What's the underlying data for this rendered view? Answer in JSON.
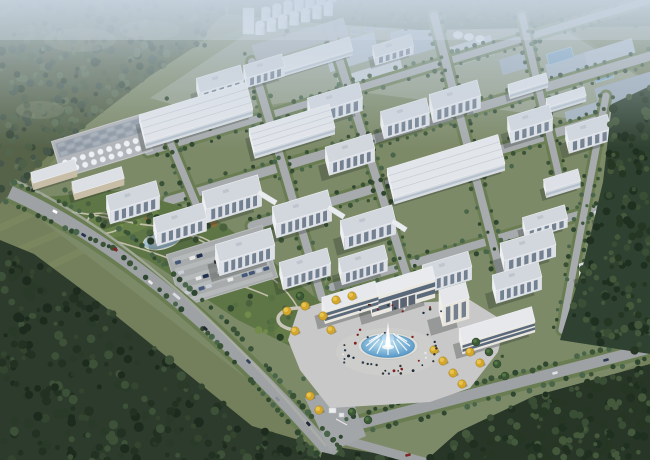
{
  "scene": {
    "kind": "aerial-architectural-rendering",
    "subject": "industrial-park-campus-birdseye",
    "canvas": {
      "width": 650,
      "height": 460
    }
  },
  "palette": {
    "field": "#74805c",
    "campus_lawn": "#7d8a68",
    "road": "#9ea2a4",
    "road_minor": "#a7abad",
    "road_verge": "#6a7d52",
    "forest_base_nw": "#566349",
    "forest_base_sw": "#2c3b2b",
    "forest_base_e": "#2f4130",
    "top_strip_base": "#4e5f45",
    "haze": "#c7d5e3",
    "roof_light": "#e0e3e8",
    "roof_ms": "#d2d7de",
    "facade_front": "#dde1e7",
    "facade_left": "#edeff2",
    "window_glass": "#5f6e80",
    "gate_glass": "#4b5c70",
    "gate_wall": "#e9e7e0",
    "plaza": "#c8c8c8",
    "water_light": "#bfe2f2",
    "water_deep": "#4f93c4",
    "pond_light": "#cfe4ee",
    "pond_deep": "#7fa4bb",
    "autumn_tree": "#d3a72c",
    "tank_white": "#edf1f5",
    "silo_white": "#f0f4f8",
    "shadow": "rgba(38,48,40,0.30)"
  },
  "axes": {
    "L": [
      0.956,
      -0.292
    ],
    "W": [
      0.24,
      0.97
    ]
  },
  "regions": {
    "campus": [
      [
        18,
        202
      ],
      [
        132,
        68
      ],
      [
        250,
        26
      ],
      [
        300,
        12
      ],
      [
        545,
        12
      ],
      [
        650,
        82
      ],
      [
        650,
        358
      ],
      [
        432,
        462
      ],
      [
        326,
        440
      ]
    ],
    "forest_nw": [
      [
        0,
        0
      ],
      [
        232,
        0
      ],
      [
        196,
        46
      ],
      [
        150,
        76
      ],
      [
        98,
        116
      ],
      [
        50,
        154
      ],
      [
        0,
        204
      ]
    ],
    "forest_sw": [
      [
        0,
        240
      ],
      [
        34,
        254
      ],
      [
        104,
        306
      ],
      [
        178,
        366
      ],
      [
        252,
        426
      ],
      [
        306,
        442
      ],
      [
        430,
        462
      ],
      [
        0,
        462
      ]
    ],
    "forest_e1": [
      [
        612,
        104
      ],
      [
        650,
        86
      ],
      [
        650,
        354
      ],
      [
        560,
        340
      ],
      [
        584,
        262
      ],
      [
        603,
        182
      ]
    ],
    "forest_e2": [
      [
        322,
        452
      ],
      [
        356,
        460
      ],
      [
        424,
        462
      ],
      [
        458,
        432
      ],
      [
        534,
        396
      ],
      [
        650,
        364
      ],
      [
        650,
        460
      ],
      [
        320,
        460
      ]
    ],
    "top_strip": [
      [
        228,
        0
      ],
      [
        650,
        0
      ],
      [
        650,
        26
      ],
      [
        420,
        30
      ],
      [
        300,
        22
      ],
      [
        228,
        14
      ]
    ],
    "park": [
      [
        34,
        198
      ],
      [
        124,
        190
      ],
      [
        208,
        214
      ],
      [
        262,
        252
      ],
      [
        318,
        300
      ],
      [
        340,
        338
      ],
      [
        306,
        354
      ],
      [
        238,
        320
      ],
      [
        148,
        260
      ],
      [
        56,
        222
      ]
    ],
    "haze_zone": [
      [
        150,
        98
      ],
      [
        252,
        30
      ],
      [
        540,
        14
      ],
      [
        650,
        84
      ],
      [
        650,
        140
      ],
      [
        580,
        120
      ],
      [
        360,
        92
      ],
      [
        205,
        114
      ]
    ],
    "plaza": [
      [
        298,
        310
      ],
      [
        330,
        300
      ],
      [
        352,
        306
      ],
      [
        470,
        300
      ],
      [
        505,
        322
      ],
      [
        498,
        352
      ],
      [
        470,
        388
      ],
      [
        430,
        402
      ],
      [
        330,
        408
      ],
      [
        300,
        370
      ],
      [
        288,
        340
      ]
    ],
    "driveway": [
      [
        305,
        398
      ],
      [
        348,
        388
      ],
      [
        366,
        436
      ],
      [
        330,
        452
      ]
    ]
  },
  "field_stripes": [
    [
      [
        0,
        228
      ],
      [
        70,
        196
      ]
    ],
    [
      [
        0,
        258
      ],
      [
        108,
        212
      ]
    ],
    [
      [
        4,
        288
      ],
      [
        92,
        246
      ]
    ]
  ],
  "haze_blocks": [
    [
      352,
      52,
      52,
      26,
      "#b4bfca"
    ],
    [
      415,
      40,
      46,
      28,
      "#a9b5c2"
    ],
    [
      468,
      52,
      52,
      20,
      "#bec8d2"
    ],
    [
      519,
      62,
      38,
      16,
      "#9fadbb"
    ],
    [
      370,
      74,
      66,
      12,
      "#c6ced6"
    ],
    [
      568,
      66,
      44,
      16,
      "#a7b4c1"
    ],
    [
      610,
      54,
      50,
      18,
      "#b2bdc8"
    ],
    [
      628,
      92,
      64,
      26,
      "#9daab8"
    ],
    [
      585,
      112,
      40,
      12,
      "#a4b1be"
    ]
  ],
  "haze_domes": [
    [
      458,
      35
    ],
    [
      469,
      37
    ],
    [
      480,
      39
    ]
  ],
  "haze_ponds": [
    [
      560,
      56,
      26,
      11
    ],
    [
      648,
      100,
      30,
      13
    ],
    [
      604,
      76,
      18,
      8
    ]
  ],
  "clarifiers": {
    "x0": 338,
    "y0": 22,
    "cols": 6,
    "rows": 2,
    "dx": 13,
    "dy": 9,
    "slope": 2.6
  },
  "silos": {
    "pad": [
      252,
      31,
      96,
      18
    ],
    "rows": [
      {
        "x0": 266,
        "y0": 19,
        "n": 7,
        "dx": 11.0,
        "dy": -3.2
      },
      {
        "x0": 260,
        "y0": 33,
        "n": 7,
        "dx": 11.4,
        "dy": -3.2
      }
    ],
    "tower": [
      243,
      8,
      11,
      26
    ]
  },
  "tank_farm": {
    "center": [
      102,
      146
    ],
    "pad": [
      55,
      127,
      94,
      38
    ],
    "cooling": {
      "x0": 60,
      "y0": 131,
      "cols": 10,
      "rows": 3,
      "dx": 8.6,
      "dy": 4.6
    },
    "tanks": {
      "x0": 62,
      "rows_y": [
        151,
        159
      ],
      "n": 9,
      "dx": 9.2,
      "r": 3
    }
  },
  "buildings": [
    [
      220,
      79,
      46,
      15,
      11,
      "ms"
    ],
    [
      264,
      66,
      40,
      13,
      10,
      "ms"
    ],
    [
      307,
      57,
      92,
      14,
      5,
      "wh"
    ],
    [
      393,
      46,
      40,
      12,
      8,
      "ms"
    ],
    [
      455,
      95,
      50,
      16,
      13,
      "ms"
    ],
    [
      528,
      83,
      40,
      9,
      6,
      "wh"
    ],
    [
      566,
      97,
      40,
      9,
      6,
      "wh"
    ],
    [
      196,
      112,
      112,
      28,
      7,
      "whB"
    ],
    [
      335,
      98,
      54,
      16,
      13,
      "ms"
    ],
    [
      405,
      112,
      48,
      15,
      13,
      "ms"
    ],
    [
      292,
      128,
      84,
      24,
      7,
      "whB"
    ],
    [
      530,
      118,
      44,
      15,
      12,
      "ms"
    ],
    [
      588,
      128,
      44,
      15,
      12,
      "ms"
    ],
    [
      632,
      158,
      40,
      15,
      12,
      "ms"
    ],
    [
      350,
      148,
      48,
      16,
      13,
      "ms"
    ],
    [
      446,
      166,
      116,
      30,
      7,
      "whB"
    ],
    [
      562,
      180,
      36,
      12,
      7,
      "wh"
    ],
    [
      614,
      211,
      38,
      10,
      6,
      "wh"
    ],
    [
      232,
      192,
      58,
      18,
      14,
      "ms"
    ],
    [
      302,
      207,
      58,
      18,
      14,
      "ms"
    ],
    [
      368,
      221,
      54,
      17,
      13,
      "ms"
    ],
    [
      133,
      196,
      52,
      16,
      13,
      "ms"
    ],
    [
      180,
      218,
      52,
      16,
      13,
      "ms"
    ],
    [
      245,
      245,
      58,
      18,
      14,
      "ms"
    ],
    [
      305,
      263,
      50,
      16,
      12,
      "ms"
    ],
    [
      363,
      259,
      48,
      15,
      12,
      "ms"
    ],
    [
      447,
      266,
      48,
      16,
      13,
      "ms"
    ],
    [
      545,
      218,
      44,
      14,
      9,
      "ms"
    ],
    [
      528,
      244,
      54,
      18,
      12,
      "ms"
    ],
    [
      517,
      276,
      48,
      16,
      13,
      "ms"
    ],
    [
      600,
      265,
      40,
      14,
      11,
      "ms"
    ],
    [
      54,
      171,
      46,
      11,
      7,
      "shed"
    ],
    [
      98,
      180,
      52,
      12,
      7,
      "shed"
    ],
    [
      350,
      296,
      56,
      14,
      13,
      "glass"
    ],
    [
      402,
      282,
      66,
      13,
      19,
      "bridgeG"
    ],
    [
      454,
      294,
      28,
      16,
      21,
      "tower"
    ],
    [
      497,
      325,
      76,
      15,
      11,
      "glass"
    ]
  ],
  "bridges": [
    [
      258,
      192,
      276,
      203
    ],
    [
      328,
      207,
      344,
      217
    ],
    [
      392,
      221,
      406,
      230
    ]
  ],
  "roads": {
    "internal_L": [
      {
        "pts": [
          [
            148,
            152
          ],
          [
            650,
            0
          ]
        ],
        "w": 7
      },
      {
        "pts": [
          [
            168,
            201
          ],
          [
            650,
            56
          ]
        ],
        "w": 9
      },
      {
        "pts": [
          [
            252,
            226
          ],
          [
            650,
            104
          ]
        ],
        "w": 9
      },
      {
        "pts": [
          [
            332,
            287
          ],
          [
            650,
            194
          ]
        ],
        "w": 8
      }
    ],
    "internal_W": [
      {
        "pts": [
          [
            160,
            118
          ],
          [
            212,
            242
          ]
        ],
        "w": 7
      },
      {
        "pts": [
          [
            252,
            62
          ],
          [
            322,
            298
          ]
        ],
        "w": 8
      },
      {
        "pts": [
          [
            330,
            30
          ],
          [
            412,
            292
          ]
        ],
        "w": 8
      },
      {
        "pts": [
          [
            434,
            16
          ],
          [
            504,
            286
          ]
        ],
        "w": 8
      },
      {
        "pts": [
          [
            522,
            16
          ],
          [
            560,
            180
          ]
        ],
        "w": 7
      },
      {
        "pts": [
          [
            606,
            96
          ],
          [
            562,
            330
          ]
        ],
        "w": 7
      }
    ],
    "main_curve": {
      "d": "M10,192 Q165,262 333,456",
      "p0": [
        10,
        192
      ],
      "p1": [
        165,
        262
      ],
      "p2": [
        333,
        456
      ],
      "w": 13
    },
    "side_path": {
      "d": "M14,180 Q162,248 326,446",
      "w": 2.5
    },
    "front": {
      "pts": [
        [
          332,
          431
        ],
        [
          650,
          348
        ]
      ],
      "w": 11
    },
    "bottom_exit": {
      "pts": [
        [
          333,
          437
        ],
        [
          424,
          462
        ]
      ],
      "w": 9
    }
  },
  "main_road_cars": [
    [
      0.14,
      "#ffffff",
      5
    ],
    [
      0.24,
      "#26334e",
      5
    ],
    [
      0.33,
      "#7e2622",
      5
    ],
    [
      0.45,
      "#e8e8e8",
      5
    ],
    [
      0.52,
      "#d9dde0",
      9
    ],
    [
      0.62,
      "#222831",
      5
    ],
    [
      0.74,
      "#31415e",
      5
    ],
    [
      0.84,
      "#8a8f94",
      5
    ],
    [
      0.92,
      "#1f2937",
      5
    ]
  ],
  "front_road_cars": [
    [
      555,
      373,
      "#dfe3e6"
    ],
    [
      606,
      360,
      "#2c3950"
    ],
    [
      408,
      455,
      "#7e2622"
    ]
  ],
  "park": {
    "paths": [
      "M42,214 C80,206 120,224 158,226 C186,228 206,246 236,258",
      "M60,222 C96,238 140,246 178,262 C210,276 246,286 268,296",
      "M92,214 C118,210 132,226 112,232 C96,237 78,228 92,214",
      "M238,262 C266,268 288,290 298,308",
      "M160,238 C180,230 200,234 214,244"
    ],
    "patches": [
      [
        120,
        222,
        40,
        14,
        "#71884f",
        0.55
      ],
      [
        230,
        270,
        44,
        16,
        "#6b8150",
        0.5
      ],
      [
        300,
        330,
        26,
        12,
        "#72884e",
        0.45
      ],
      [
        180,
        250,
        30,
        10,
        "#4c6239",
        0.5
      ]
    ],
    "pond": {
      "cx": 162,
      "cy": 240,
      "rx": 19,
      "ry": 9,
      "rot": -14
    },
    "circle_plaza": {
      "cx": 298,
      "cy": 319,
      "rx": 20,
      "ry": 11
    },
    "autumn_accents": [
      [
        214,
        224
      ],
      [
        148,
        218
      ]
    ]
  },
  "parking": {
    "center": [
      222,
      266
    ],
    "pad": [
      172,
      239,
      100,
      54
    ],
    "lanes": 5,
    "car_rows": 4,
    "slots": 12,
    "slot_dx": 7.5,
    "occupancy": 0.74,
    "car_colors": [
      "#22304f",
      "#9ab54e",
      "#e8e8e8",
      "#6e2020",
      "#2a2a2a",
      "#44597a",
      "#c7cdd4"
    ]
  },
  "fountain": {
    "cx": 388,
    "cy": 346,
    "rx": 30,
    "ry": 13.5,
    "jets": 12
  },
  "gate_booth": {
    "hut": [
      329,
      408,
      7,
      5
    ],
    "hut2": [
      339,
      413,
      5,
      4
    ],
    "bar": [
      [
        336,
        419
      ],
      [
        347,
        425
      ]
    ]
  },
  "autumn_trees": [
    [
      323,
      316
    ],
    [
      331,
      330
    ],
    [
      310,
      396
    ],
    [
      319,
      410
    ],
    [
      336,
      300
    ],
    [
      352,
      296
    ],
    [
      434,
      350
    ],
    [
      443,
      361
    ],
    [
      453,
      373
    ],
    [
      462,
      384
    ],
    [
      287,
      311
    ],
    [
      305,
      306
    ],
    [
      295,
      331
    ],
    [
      470,
      352
    ],
    [
      480,
      363
    ]
  ],
  "plaza_green_trees": [
    [
      489,
      352
    ],
    [
      497,
      364
    ],
    [
      505,
      376
    ],
    [
      352,
      412
    ],
    [
      368,
      420
    ],
    [
      300,
      296
    ],
    [
      476,
      342
    ]
  ],
  "scatter": {
    "forest_nw": {
      "n": 340,
      "rmin": 2,
      "rmax": 4.5,
      "colors": [
        "#47584a",
        "#54664e",
        "#3b4c3c",
        "#5e7055",
        "#4e6047"
      ]
    },
    "forest_sw": {
      "n": 300,
      "rmin": 2,
      "rmax": 5,
      "colors": [
        "#223122",
        "#34452f",
        "#1d2b1e",
        "#3d5138",
        "#2a3a28"
      ]
    },
    "forest_e1": {
      "n": 150,
      "rmin": 2,
      "rmax": 4.5,
      "colors": [
        "#253623",
        "#3a4e35",
        "#1f2f20",
        "#44583c"
      ]
    },
    "forest_e2": {
      "n": 160,
      "rmin": 2,
      "rmax": 4.5,
      "colors": [
        "#253623",
        "#3a4e35",
        "#1f2f20",
        "#44583c"
      ]
    },
    "top_strip": {
      "n": 110,
      "rmin": 1.5,
      "rmax": 3,
      "colors": [
        "#3c4d38",
        "#5a6b4e",
        "#455843"
      ]
    },
    "park": {
      "n": 75,
      "rmin": 2,
      "rmax": 4.5,
      "colors": [
        "#33492f",
        "#49613d",
        "#2a3f28",
        "#557042",
        "#728b4a"
      ]
    },
    "campus_lawn_trees": {
      "n": 40,
      "rmin": 1.6,
      "rmax": 2.8,
      "colors": [
        "#3a5336",
        "#49654a",
        "#2f4730"
      ]
    }
  },
  "people": {
    "ring_count": 38,
    "gate_line_count": 14,
    "colors": [
      "#1c2a3a",
      "#7e1f1c",
      "#e8e8e8",
      "#2f3f56",
      "#333333"
    ]
  }
}
